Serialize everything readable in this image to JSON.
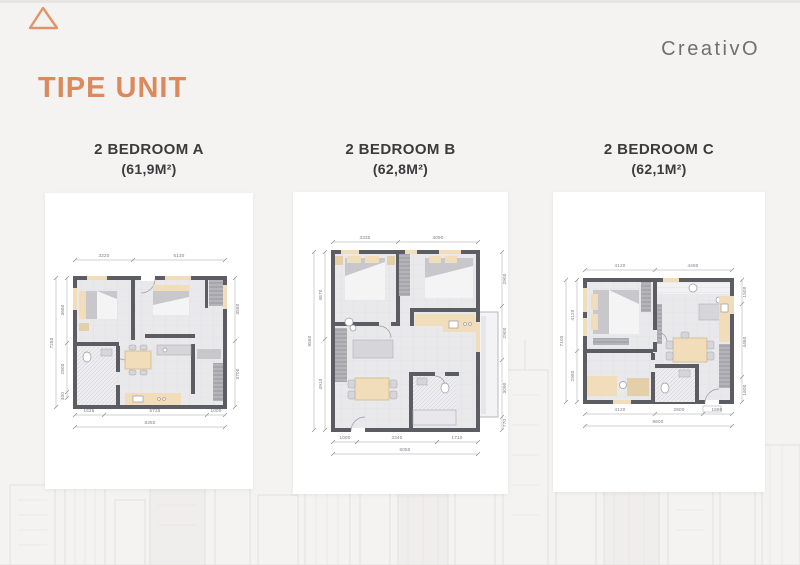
{
  "slide": {
    "title": "TIPE UNIT",
    "logo_text": "CreativO"
  },
  "colors": {
    "accent_orange": "#DB8A5E",
    "heading_text": "#3B3B3D",
    "logo_gray": "#707070",
    "wall_gray": "#5C5C63",
    "furniture_beige": "#F1DDBA",
    "background": "#F4F3F1"
  },
  "decor": {
    "corner_triangle": "triangle-outline-icon",
    "watermark": "city-skyline-sketch"
  },
  "units": [
    {
      "name": "2 BEDROOM A",
      "area": "(61,9M²)",
      "dims": {
        "top": [
          "3220",
          "5130"
        ],
        "left": [
          "3660",
          "2800",
          "300"
        ],
        "left_total": "7280",
        "right": [
          "3580",
          "3700"
        ],
        "bottom": [
          "1625",
          "5725",
          "1000"
        ],
        "bottom_total": "8350"
      }
    },
    {
      "name": "2 BEDROOM B",
      "area": "(62,8M²)",
      "dims": {
        "top": [
          "3330",
          "4090"
        ],
        "left": [
          "4670",
          "4910"
        ],
        "left_total": "9580",
        "right": [
          "2900",
          "2900",
          "3090",
          "770"
        ],
        "bottom": [
          "1000",
          "3340",
          "1710"
        ],
        "bottom_total": "6050"
      }
    },
    {
      "name": "2 BEDROOM C",
      "area": "(62,1M²)",
      "dims": {
        "top": [
          "4120",
          "4480"
        ],
        "left": [
          "4120",
          "2980"
        ],
        "left_total": "7100",
        "right": [
          "1500",
          "4460",
          "1600"
        ],
        "bottom": [
          "4120",
          "2800",
          "1680"
        ],
        "bottom_total": "8600"
      }
    }
  ]
}
